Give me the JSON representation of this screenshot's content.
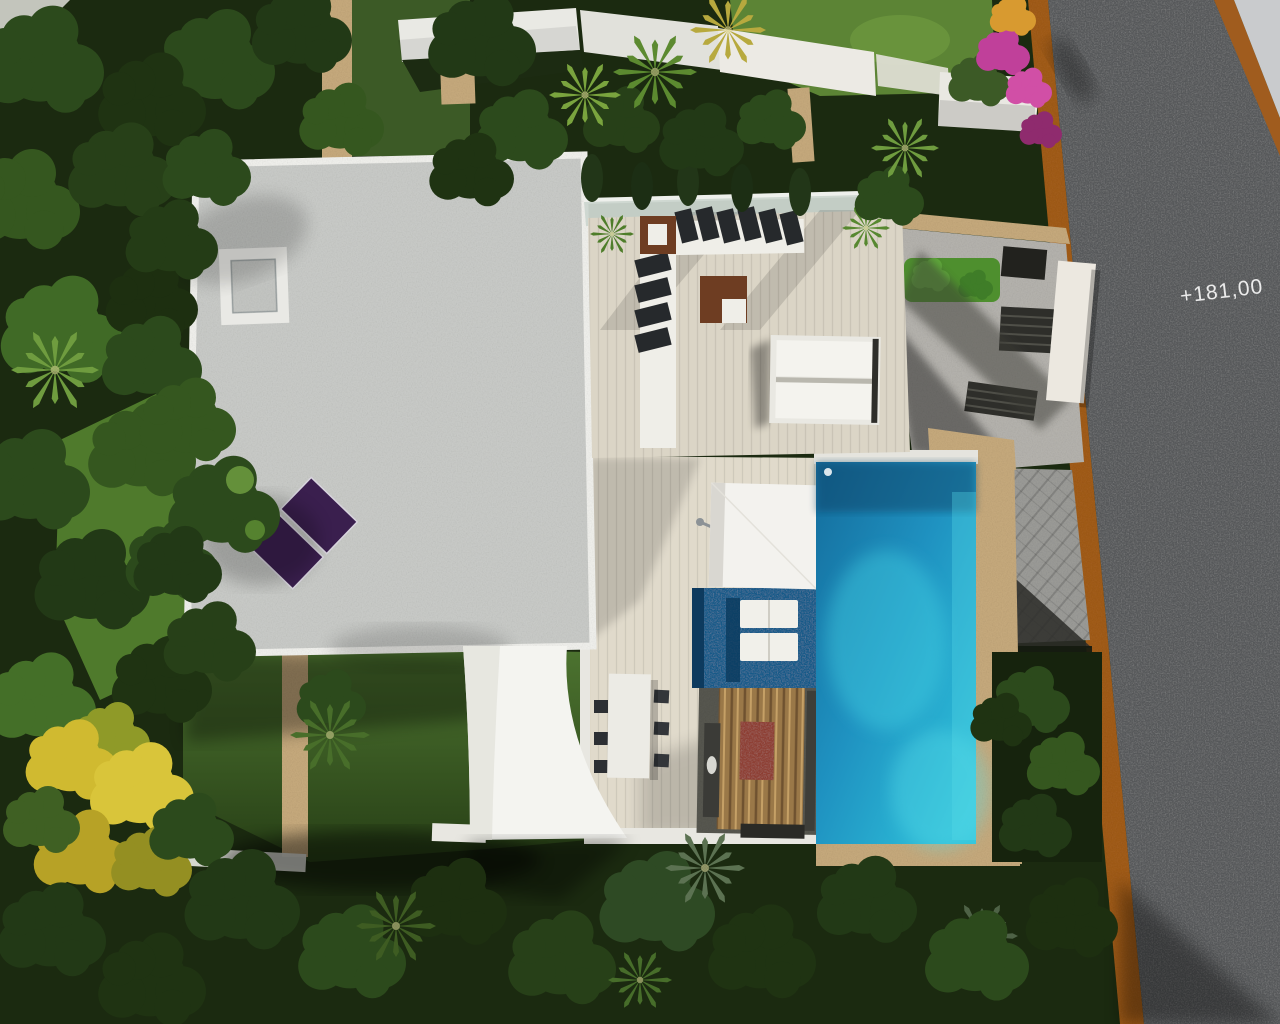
{
  "scene": {
    "title": "Aerial 3D render of a modern villa plot with pool, gardens and road",
    "elevation_label": "+181,00",
    "objects": [
      "main-house-flat-roof",
      "roof-skylight",
      "solar-panels",
      "upper-wood-deck",
      "l-shaped-sofa",
      "coffee-table",
      "corner-table",
      "double-daybed",
      "lower-terrace",
      "square-parasol",
      "spa-plunge-pool",
      "spa-loungers",
      "main-swimming-pool",
      "stone-pool-surround",
      "paved-driveway",
      "entrance-courtyard",
      "entrance-steps",
      "entry-gate-structure",
      "shade-sail",
      "outdoor-dining-table",
      "outdoor-kitchen",
      "garden-lawn",
      "yellow-flowering-tree",
      "palm-trees",
      "conifer-hedge",
      "bougainvillea",
      "road",
      "corten-road-edging",
      "sidewalk",
      "elevation-marker"
    ]
  },
  "colors": {
    "road": "#56585a",
    "corten": "#a05c1e",
    "sidewalk": "#c9cbcd",
    "roof_gravel": "#c7c9c6",
    "parapet_white": "#eeeeea",
    "deck_wood": "#dbd5c6",
    "terrace_wood": "#e0dacb",
    "pool_water": "#1d86b4",
    "pool_light": "#38cde0",
    "spa_water": "#175a88",
    "stone_border": "#c4a87c",
    "paving": "#9a9a96",
    "concrete": "#b3b1ac",
    "shade_sail": "#f4f4f0",
    "parasol": "#f3f2ee",
    "solar_panel": "#3a1f4e",
    "hedge_green": "#4e8f2e",
    "grass_bright": "#5c8435",
    "grass_lawn": "#44682a",
    "foliage_dark": "#1d2f10",
    "yellow_tree": "#d0ba30",
    "bougainvillea": "#c0409a",
    "furniture_white": "#efeee8",
    "cushion_dark": "#26292c",
    "table_brown": "#6e3d22",
    "label_text": "#ebebeb"
  }
}
